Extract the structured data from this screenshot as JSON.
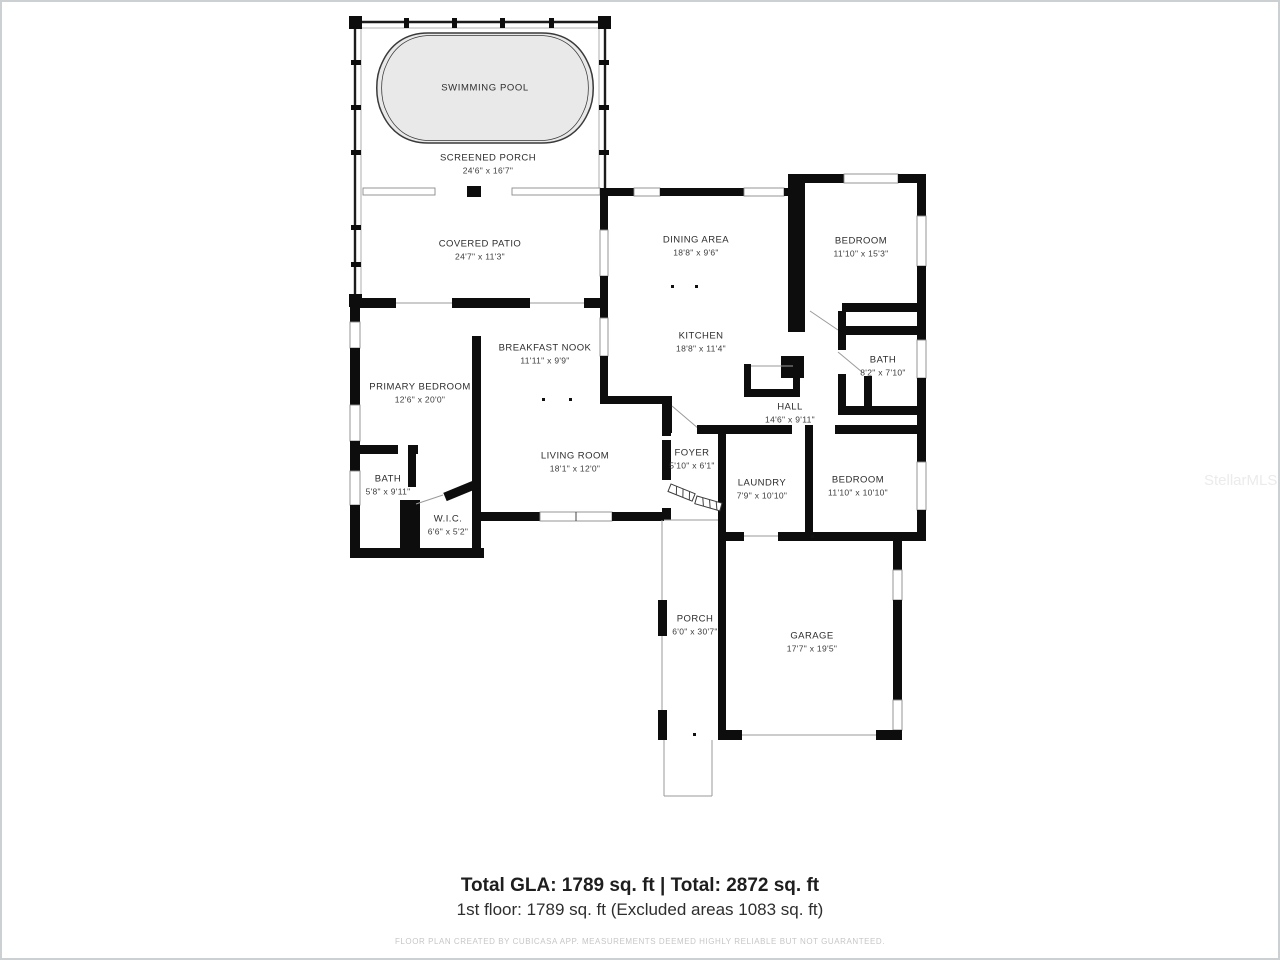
{
  "watermark": "StellarMLS",
  "pool_label": "SWIMMING POOL",
  "rooms": {
    "screened_porch": {
      "name": "SCREENED PORCH",
      "dims": "24'6\" x 16'7\""
    },
    "covered_patio": {
      "name": "COVERED PATIO",
      "dims": "24'7\" x 11'3\""
    },
    "dining_area": {
      "name": "DINING AREA",
      "dims": "18'8\" x 9'6\""
    },
    "kitchen": {
      "name": "KITCHEN",
      "dims": "18'8\" x 11'4\""
    },
    "bedroom_top": {
      "name": "BEDROOM",
      "dims": "11'10\" x 15'3\""
    },
    "bath_right": {
      "name": "BATH",
      "dims": "8'2\" x 7'10\""
    },
    "breakfast_nook": {
      "name": "BREAKFAST NOOK",
      "dims": "11'11\" x 9'9\""
    },
    "primary_bedroom": {
      "name": "PRIMARY BEDROOM",
      "dims": "12'6\" x 20'0\""
    },
    "hall": {
      "name": "HALL",
      "dims": "14'6\" x 9'11\""
    },
    "living_room": {
      "name": "LIVING ROOM",
      "dims": "18'1\" x 12'0\""
    },
    "foyer": {
      "name": "FOYER",
      "dims": "5'10\" x 6'1\""
    },
    "laundry": {
      "name": "LAUNDRY",
      "dims": "7'9\" x 10'10\""
    },
    "bedroom_right": {
      "name": "BEDROOM",
      "dims": "11'10\" x 10'10\""
    },
    "bath_left": {
      "name": "BATH",
      "dims": "5'8\" x 9'11\""
    },
    "wic": {
      "name": "W.I.C.",
      "dims": "6'6\" x 5'2\""
    },
    "porch": {
      "name": "PORCH",
      "dims": "6'0\" x 30'7\""
    },
    "garage": {
      "name": "GARAGE",
      "dims": "17'7\" x 19'5\""
    }
  },
  "summary": {
    "totals": "Total GLA: 1789 sq. ft | Total: 2872 sq. ft",
    "first_floor": "1st floor: 1789 sq. ft (Excluded areas 1083 sq. ft)",
    "disclaimer": "FLOOR PLAN CREATED BY CUBICASA APP. MEASUREMENTS DEEMED HIGHLY RELIABLE BUT NOT GUARANTEED."
  },
  "colors": {
    "wall": "#0d0d0d",
    "pool_fill": "#e9e9e9",
    "window_stroke": "#8a8a8a",
    "disclaimer_text": "#c6c6c6",
    "watermark_text": "#ebebeb"
  }
}
